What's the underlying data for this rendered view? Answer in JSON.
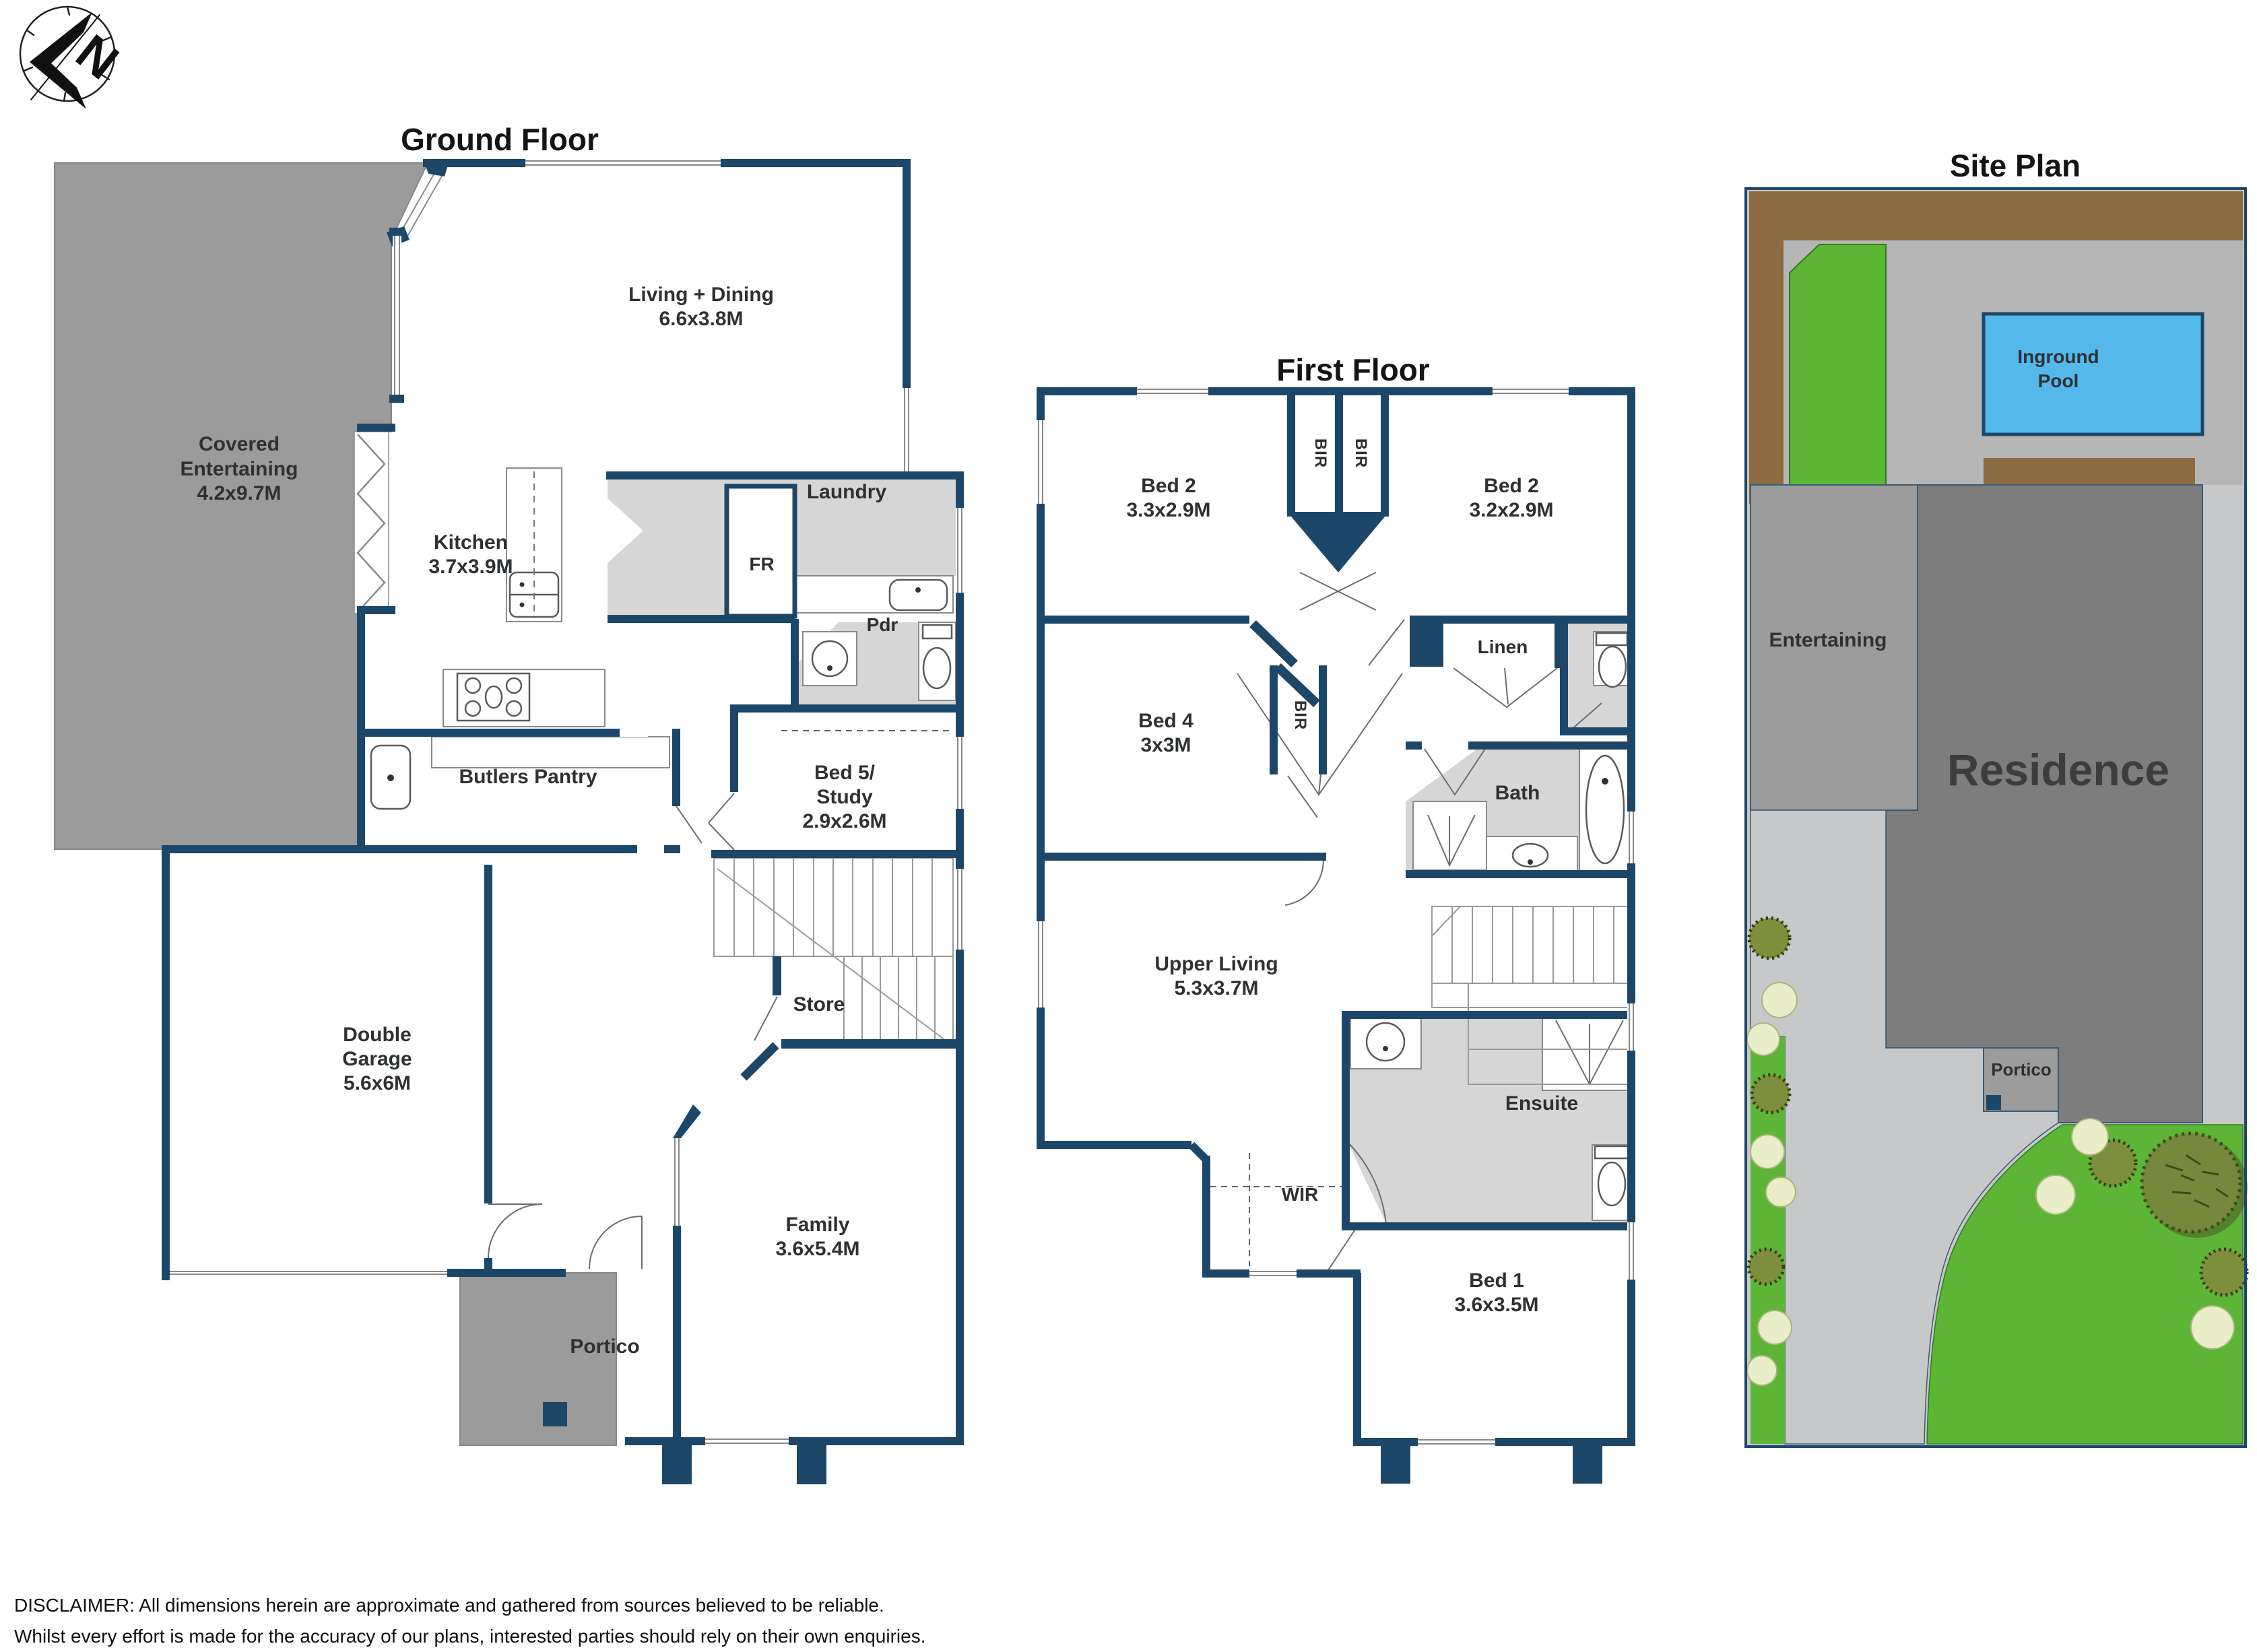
{
  "meta": {
    "type": "real-estate floor plan",
    "icons": {
      "logo": "compass-north-icon"
    },
    "colors": {
      "wall_navy": "#1d4768",
      "wet_area_gray": "#d6d6d6",
      "outdoor_gray": "#9b9b9b",
      "site_base_gray": "#c7c8ca",
      "site_deck_gray": "#b6b6b6",
      "site_entertaining_gray": "#9c9c9c",
      "site_residence_gray": "#7d7d7d",
      "site_brown": "#8c6b40",
      "site_lawn_green": "#5cb535",
      "pool_blue": "#54b8ea",
      "thin_line_gray": "#8a8a8a"
    }
  },
  "ground_floor": {
    "title": "Ground Floor",
    "covered_entertaining": {
      "line1": "Covered",
      "line2": "Entertaining",
      "dims": "4.2x9.7M"
    },
    "living_dining": {
      "name": "Living + Dining",
      "dims": "6.6x3.8M"
    },
    "kitchen": {
      "name": "Kitchen",
      "dims": "3.7x3.9M"
    },
    "laundry": {
      "name": "Laundry"
    },
    "fr": {
      "name": "FR"
    },
    "pdr": {
      "name": "Pdr"
    },
    "butlers_pantry": {
      "name": "Butlers Pantry"
    },
    "bed5_study": {
      "line1": "Bed 5/",
      "line2": "Study",
      "dims": "2.9x2.6M"
    },
    "double_garage": {
      "line1": "Double",
      "line2": "Garage",
      "dims": "5.6x6M"
    },
    "store": {
      "name": "Store"
    },
    "family": {
      "name": "Family",
      "dims": "3.6x5.4M"
    },
    "portico": {
      "name": "Portico"
    }
  },
  "first_floor": {
    "title": "First Floor",
    "bed2_left": {
      "name": "Bed 2",
      "dims": "3.3x2.9M"
    },
    "bed2_right": {
      "name": "Bed 2",
      "dims": "3.2x2.9M"
    },
    "bir1": {
      "name": "BIR"
    },
    "bir2": {
      "name": "BIR"
    },
    "bir3": {
      "name": "BIR"
    },
    "linen": {
      "name": "Linen"
    },
    "bed4": {
      "name": "Bed 4",
      "dims": "3x3M"
    },
    "bath": {
      "name": "Bath"
    },
    "upper_living": {
      "name": "Upper Living",
      "dims": "5.3x3.7M"
    },
    "ensuite": {
      "name": "Ensuite"
    },
    "wir": {
      "name": "WIR"
    },
    "bed1": {
      "name": "Bed 1",
      "dims": "3.6x3.5M"
    }
  },
  "site_plan": {
    "title": "Site Plan",
    "pool": {
      "line1": "Inground",
      "line2": "Pool"
    },
    "entertaining": {
      "name": "Entertaining"
    },
    "residence": {
      "name": "Residence"
    },
    "portico": {
      "name": "Portico"
    }
  },
  "disclaimer": {
    "line1": "DISCLAIMER:  All dimensions herein are approximate and gathered from sources believed to be reliable.",
    "line2": "Whilst every effort is made for the accuracy of our plans, interested parties should rely on their own enquiries."
  }
}
